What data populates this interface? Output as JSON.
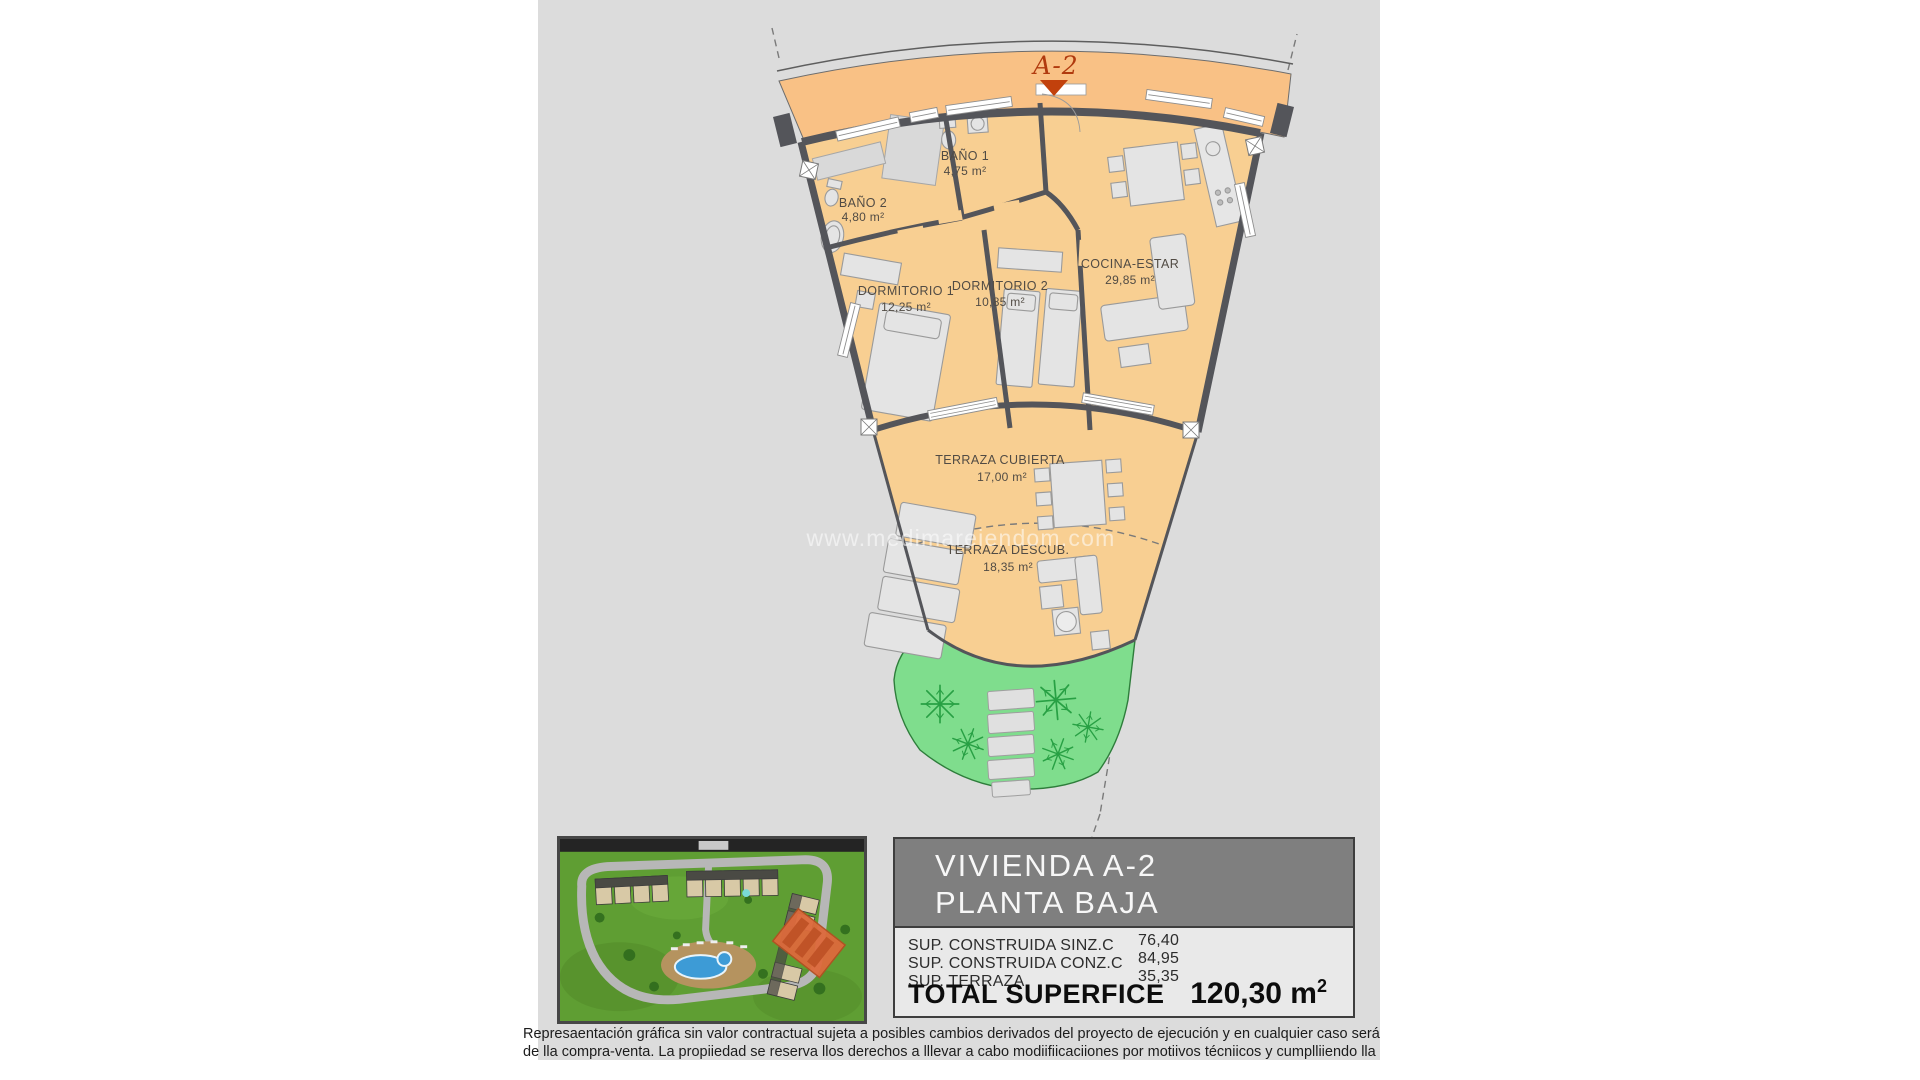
{
  "watermark": "www.medimareiendom.com",
  "plan": {
    "unit_marker": "A-2",
    "rooms": [
      {
        "name": "BAÑO 1",
        "area": "4,75 m²"
      },
      {
        "name": "BAÑO 2",
        "area": "4,80 m²"
      },
      {
        "name": "DORMITORIO 1",
        "area": "12,25 m²"
      },
      {
        "name": "DORMITORIO 2",
        "area": "10,85 m²"
      },
      {
        "name": "COCINA-ESTAR",
        "area": "29,85 m²"
      },
      {
        "name": "TERRAZA CUBIERTA",
        "area": "17,00 m²"
      },
      {
        "name": "TERRAZA DESCUB.",
        "area": "18,35 m²"
      }
    ]
  },
  "info_panel": {
    "title_line1": "VIVIENDA A-2",
    "title_line2": "PLANTA BAJA",
    "rows": [
      {
        "label": "SUP. CONSTRUIDA SINZ.C",
        "value": "76,40"
      },
      {
        "label": "SUP. CONSTRUIDA CONZ.C",
        "value": "84,95"
      },
      {
        "label": "SUP. TERRAZA",
        "value": "35,35"
      }
    ],
    "total_label": "TOTAL SUPERFICE",
    "total_value": "120,30 m",
    "total_exponent": "2"
  },
  "disclaimer": {
    "line1": "Represaentación gráfica sin valor contractual sujeta a posibles cambios derivados del proyecto de ejecución y en cualquier caso será sustituido por el definitivo en",
    "line2": "de lla compra-venta. La propiiedad se reserva llos derechos a lllevar a cabo modiifiicaciiones por motiivos técniicos y cumplliiendo lla normatiiva viigente."
  },
  "colors": {
    "band_orange": "#f9c185",
    "floor_orange": "#f8cf92",
    "wall_gray": "#54555a",
    "garden_green": "#7fdd8d",
    "marker_red": "#c2410c",
    "sheet_gray": "#dcdcdc",
    "panel_header_gray": "#7f7f7f"
  }
}
